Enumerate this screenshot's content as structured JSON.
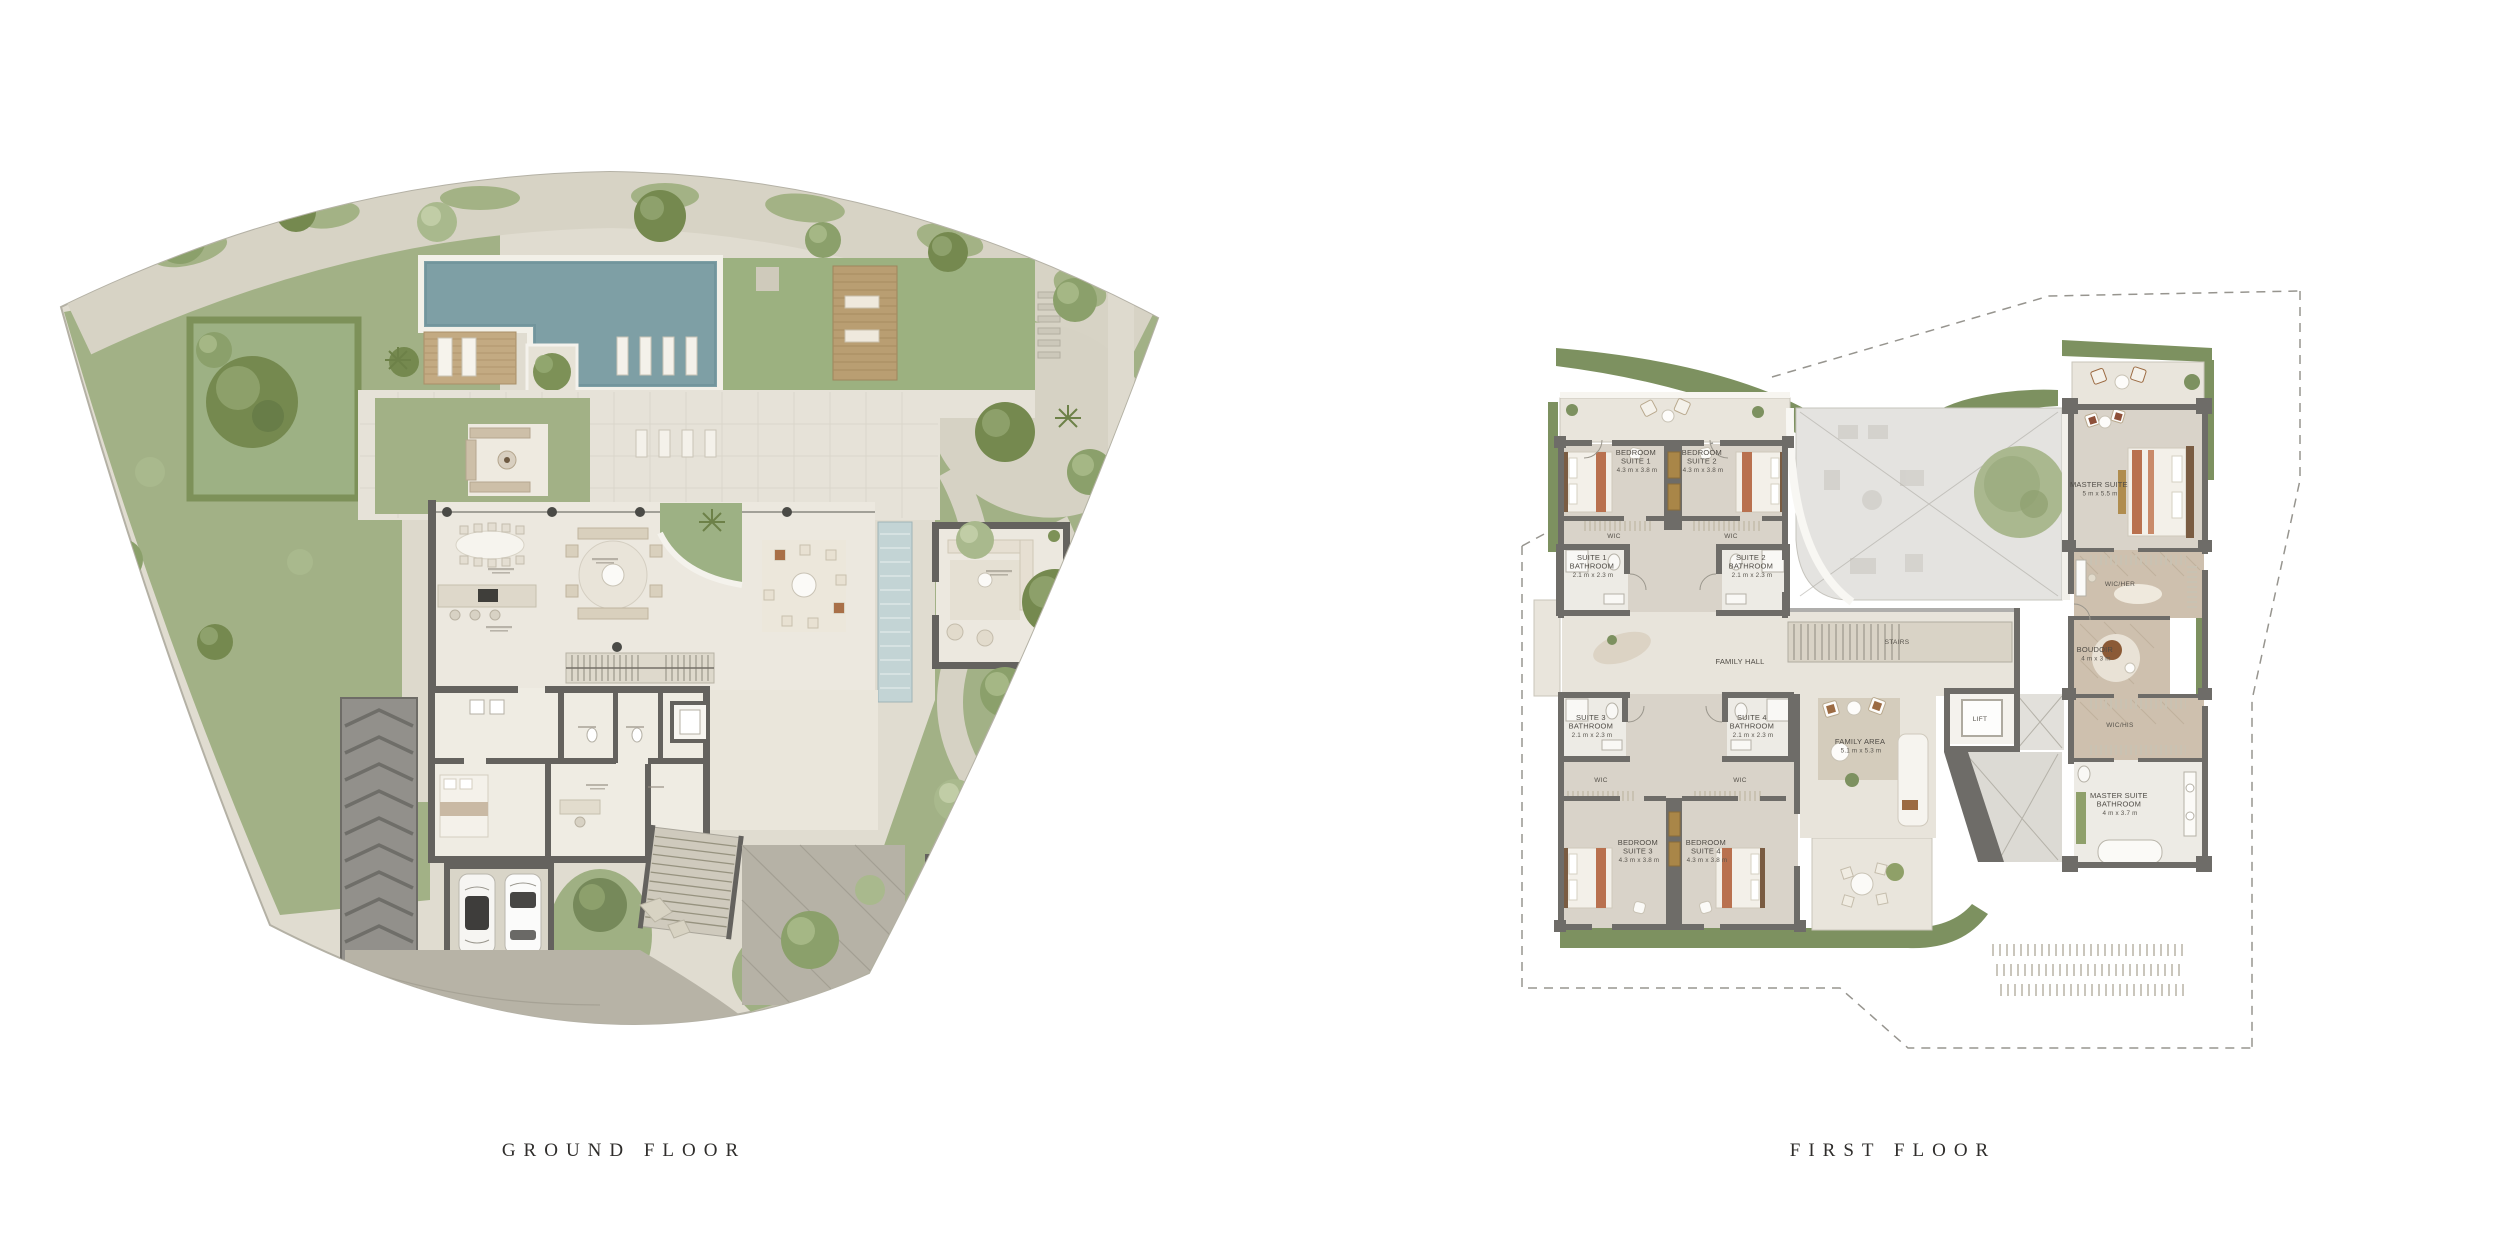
{
  "ground_floor": {
    "caption": "GROUND FLOOR"
  },
  "first_floor": {
    "caption": "FIRST FLOOR",
    "labels": {
      "bedroom_suite_1": {
        "l1": "BEDROOM",
        "l2": "SUITE 1",
        "dims": "4.3 m x 3.8 m"
      },
      "bedroom_suite_2": {
        "l1": "BEDROOM",
        "l2": "SUITE 2",
        "dims": "4.3 m x 3.8 m"
      },
      "bedroom_suite_3": {
        "l1": "BEDROOM",
        "l2": "SUITE 3",
        "dims": "4.3 m x 3.8 m"
      },
      "bedroom_suite_4": {
        "l1": "BEDROOM",
        "l2": "SUITE 4",
        "dims": "4.3 m x 3.8 m"
      },
      "suite_1_bathroom": {
        "l1": "SUITE 1",
        "l2": "BATHROOM",
        "dims": "2.1 m x 2.3 m"
      },
      "suite_2_bathroom": {
        "l1": "SUITE 2",
        "l2": "BATHROOM",
        "dims": "2.1 m x 2.3 m"
      },
      "suite_3_bathroom": {
        "l1": "SUITE 3",
        "l2": "BATHROOM",
        "dims": "2.1 m x 2.3 m"
      },
      "suite_4_bathroom": {
        "l1": "SUITE 4",
        "l2": "BATHROOM",
        "dims": "2.1 m x 2.3 m"
      },
      "wic": "WIC",
      "wic_her": "WIC/HER",
      "wic_his": "WIC/HIS",
      "family_hall": "FAMILY HALL",
      "stairs": "STAIRS",
      "lift": "LIFT",
      "master_suite": {
        "l1": "MASTER SUITE",
        "dims": "5 m x 5.5 m"
      },
      "boudoir": {
        "l1": "BOUDOIR",
        "dims": "4 m x 3 m"
      },
      "master_suite_bathroom": {
        "l1": "MASTER SUITE",
        "l2": "BATHROOM",
        "dims": "4 m x 3.7 m"
      },
      "family_area": {
        "l1": "FAMILY AREA",
        "dims": "5.1 m x 5.3 m"
      }
    }
  },
  "palette": {
    "background": "#ffffff",
    "caption_text": "#2f2d2b",
    "label_text": "#4f4b45",
    "walls": "#6b6966",
    "pool_water": "#7e9fa5",
    "lawn_green": "#9cb180",
    "site_green": "#a2b186",
    "roof_garden_green": "#7d9160",
    "hall_floor": "#ece8df",
    "bedroom_floor": "#d9d3c9",
    "wic_floor": "#cec0ae",
    "bath_floor": "#edebe5",
    "terracotta_accent": "#b9714f",
    "wood_accent": "#a98648",
    "pebble_path": "#d6d2c4",
    "driveway_pavers": "#b7b3a6"
  }
}
